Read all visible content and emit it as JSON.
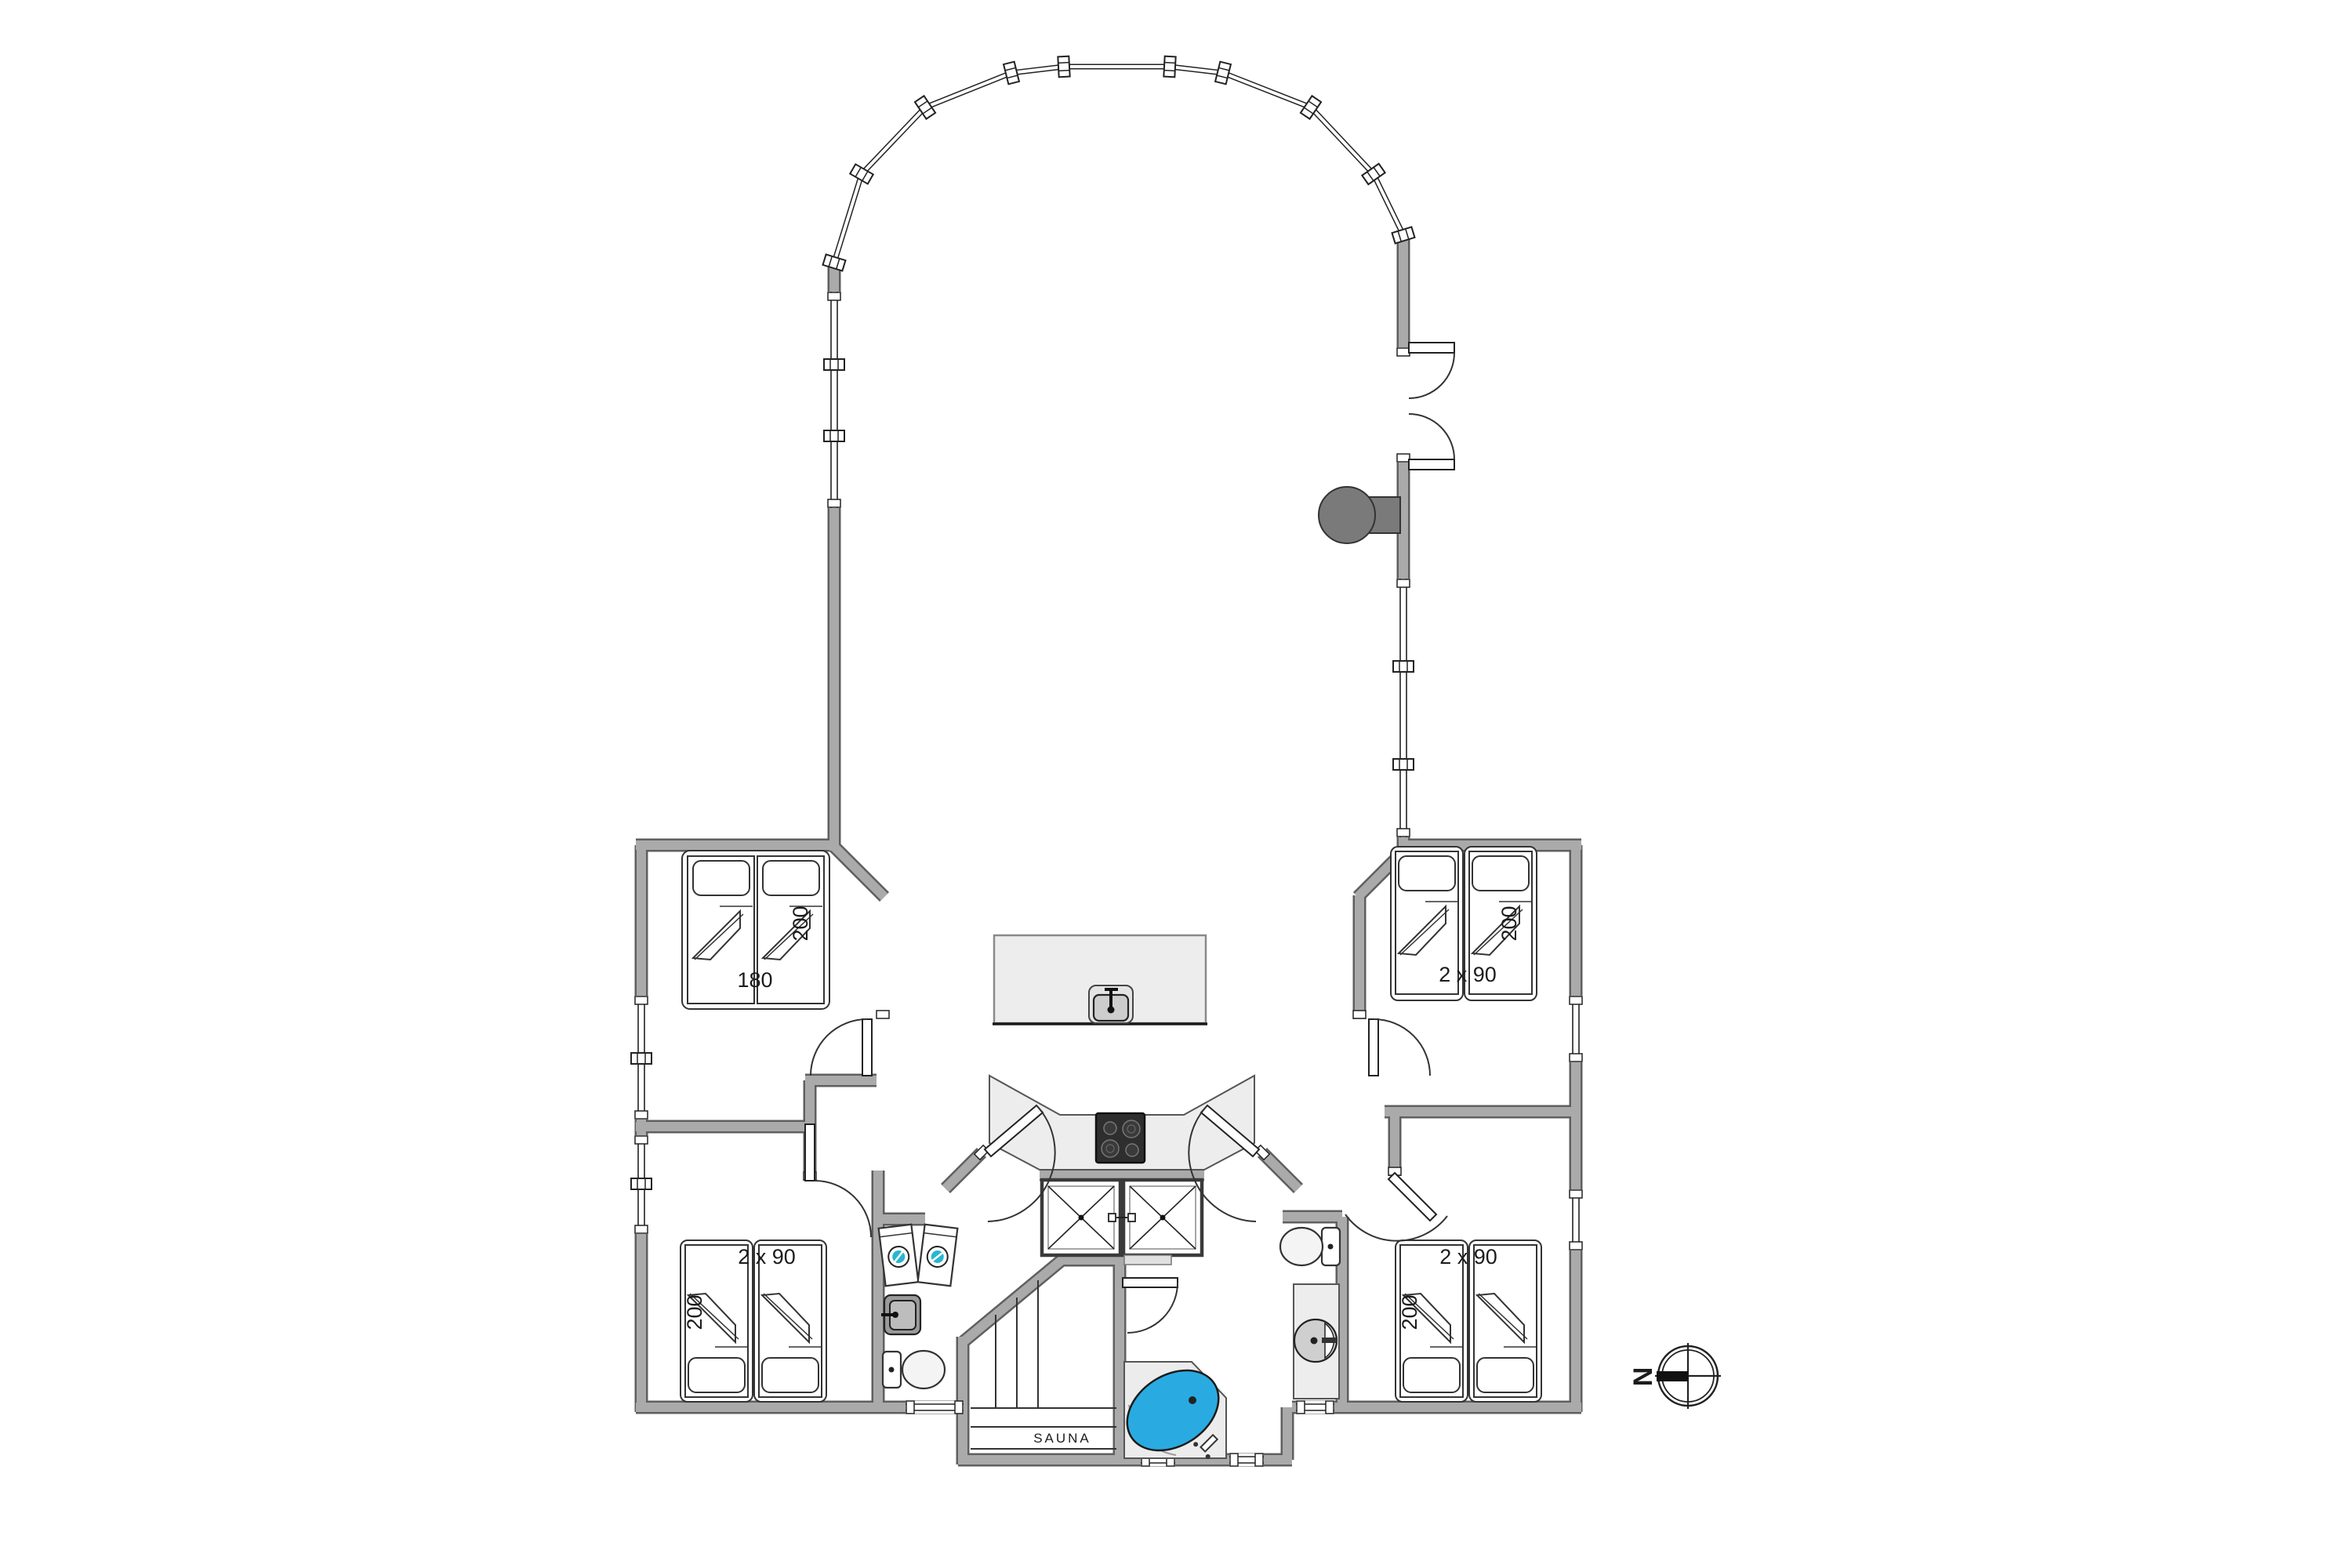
{
  "plan": {
    "type": "holiday-house floor plan",
    "rooms": {
      "bedroom_top_left": {
        "bed_width_label": "180",
        "bed_length_label": "200"
      },
      "bedroom_top_right": {
        "bed_width_label": "2 x 90",
        "bed_length_label": "200"
      },
      "bedroom_bottom_left": {
        "bed_width_label": "2 x 90",
        "bed_length_label": "200"
      },
      "bedroom_bottom_right": {
        "bed_width_label": "2 x 90",
        "bed_length_label": "200"
      },
      "sauna": {
        "label": "SAUNA"
      }
    },
    "compass": {
      "north_label": "N",
      "north_points": "left"
    }
  },
  "colors": {
    "wall": "#aaaaaa",
    "wall_edge": "#5f5f5f",
    "counter": "#ededed",
    "island": "#ededed",
    "step": "#e0e0e0",
    "tub_platform": "#ececec",
    "tub_water": "#29abe2",
    "stove": "#7a7a7a",
    "cooktop": "#2e2e2e",
    "washer_door": "#29b6cf",
    "sink_dark": "#9a9a9a"
  }
}
